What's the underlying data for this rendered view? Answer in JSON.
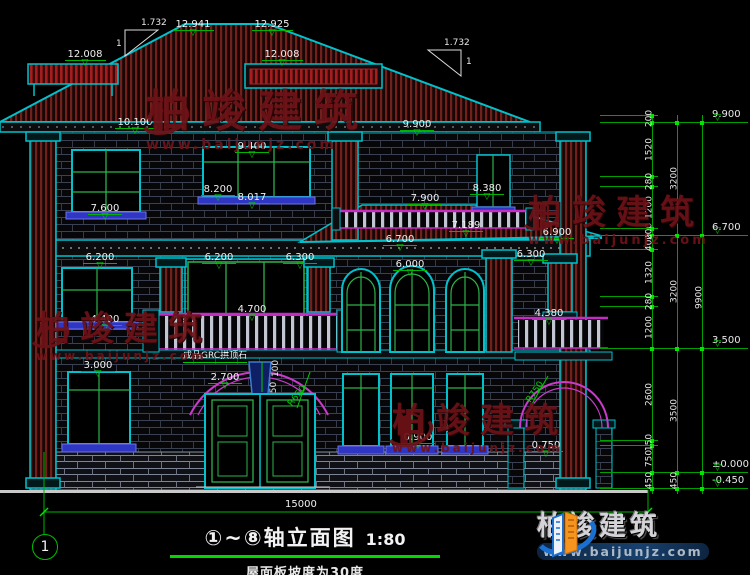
{
  "drawing": {
    "title": "①~⑧轴立面图",
    "scale": "1:80",
    "subtitle": "屋面板坡度为30度",
    "axis_bubble": "1",
    "bottom_dim": "15000",
    "keystone_note": "成品GRC拱顶石"
  },
  "elevation_markers": [
    {
      "t": "12.008",
      "x": 85,
      "y": 42
    },
    {
      "t": "12.941",
      "x": 193,
      "y": 12
    },
    {
      "t": "12.925",
      "x": 272,
      "y": 12
    },
    {
      "t": "12.008",
      "x": 282,
      "y": 42
    },
    {
      "t": "10.100",
      "x": 135,
      "y": 110
    },
    {
      "t": "9.900",
      "x": 417,
      "y": 112
    },
    {
      "t": "9.400",
      "x": 252,
      "y": 134
    },
    {
      "t": "8.380",
      "x": 487,
      "y": 176
    },
    {
      "t": "8.200",
      "x": 218,
      "y": 177
    },
    {
      "t": "8.017",
      "x": 252,
      "y": 185
    },
    {
      "t": "7.600",
      "x": 105,
      "y": 196
    },
    {
      "t": "7.900",
      "x": 425,
      "y": 186
    },
    {
      "t": "7.189",
      "x": 466,
      "y": 213
    },
    {
      "t": "6.900",
      "x": 557,
      "y": 220
    },
    {
      "t": "6.700",
      "x": 400,
      "y": 227
    },
    {
      "t": "6.300",
      "x": 531,
      "y": 242
    },
    {
      "t": "6.200",
      "x": 100,
      "y": 245
    },
    {
      "t": "6.200",
      "x": 219,
      "y": 245
    },
    {
      "t": "6.300",
      "x": 300,
      "y": 245
    },
    {
      "t": "6.000",
      "x": 410,
      "y": 252
    },
    {
      "t": "4.700",
      "x": 252,
      "y": 297
    },
    {
      "t": "4.400",
      "x": 105,
      "y": 307
    },
    {
      "t": "4.380",
      "x": 549,
      "y": 301
    },
    {
      "t": "3.000",
      "x": 98,
      "y": 353
    },
    {
      "t": "2.700",
      "x": 225,
      "y": 365
    },
    {
      "t": "0.900",
      "x": 418,
      "y": 425
    },
    {
      "t": "0.750",
      "x": 546,
      "y": 433
    }
  ],
  "annotations": [
    {
      "t": "1.732",
      "x": 141,
      "y": 19,
      "color": "#e8e8e8"
    },
    {
      "t": "1",
      "x": 116,
      "y": 40,
      "color": "#e8e8e8"
    },
    {
      "t": "1.732",
      "x": 444,
      "y": 39,
      "color": "#e8e8e8"
    },
    {
      "t": "1",
      "x": 466,
      "y": 58,
      "color": "#e8e8e8"
    },
    {
      "t": "100",
      "x": 268,
      "y": 364,
      "rot": -90,
      "color": "#e8e8e8"
    },
    {
      "t": "50",
      "x": 269,
      "y": 383,
      "rot": -90,
      "color": "#e8e8e8"
    },
    {
      "t": "R650",
      "x": 286,
      "y": 392,
      "rot": -52,
      "color": "#00d200"
    },
    {
      "t": "R750",
      "x": 524,
      "y": 388,
      "rot": -55,
      "color": "#00d200"
    }
  ],
  "right_chain": {
    "col1": [
      [
        "200",
        114
      ],
      [
        "1520",
        145
      ],
      [
        "280",
        177
      ],
      [
        "1200",
        203
      ],
      [
        "200",
        227
      ],
      [
        "400",
        238
      ],
      [
        "1320",
        268
      ],
      [
        "280",
        297
      ],
      [
        "1200",
        323
      ],
      [
        "2600",
        390
      ],
      [
        "150",
        438
      ],
      [
        "750",
        454
      ],
      [
        "450",
        476
      ]
    ],
    "col2": [
      [
        "3200",
        174
      ],
      [
        "3200",
        287
      ],
      [
        "3500",
        406
      ],
      [
        "450",
        476
      ]
    ],
    "col3": [
      [
        "9900",
        293
      ]
    ],
    "bounds_minor": [
      115,
      176,
      186,
      228,
      249,
      296,
      306,
      440,
      445
    ],
    "bounds_major": [
      122,
      235,
      348,
      472,
      488
    ],
    "levels": [
      [
        "9.900",
        122
      ],
      [
        "6.700",
        235
      ],
      [
        "3.500",
        348
      ],
      [
        "±0.000",
        472
      ],
      [
        "-0.450",
        488
      ]
    ]
  },
  "watermark": {
    "brand": "柏竣建筑",
    "url": "www.baijunjz.com",
    "positions": [
      {
        "x": 138,
        "y": 90,
        "big": 44,
        "url": 14,
        "icon": 52
      },
      {
        "x": 28,
        "y": 312,
        "big": 34,
        "url": 12,
        "icon": 42
      },
      {
        "x": 520,
        "y": 196,
        "big": 34,
        "url": 13,
        "icon": 40
      },
      {
        "x": 384,
        "y": 404,
        "big": 34,
        "url": 12,
        "icon": 50
      }
    ]
  },
  "logo": {
    "brand": "柏竣建筑",
    "url": "www.baijunjz.com"
  },
  "colors": {
    "outline_cyan": "#00c2cc",
    "annotation_green": "#00d200",
    "roof_red": "#71201c",
    "bright_red": "#a51d1d",
    "rail_magenta": "#c42cc4",
    "sill_blue": "#2f36c4",
    "watermark_maroon": "#6d1217",
    "logo_orange": "#f7941e",
    "logo_blue": "#1b6fd0"
  }
}
